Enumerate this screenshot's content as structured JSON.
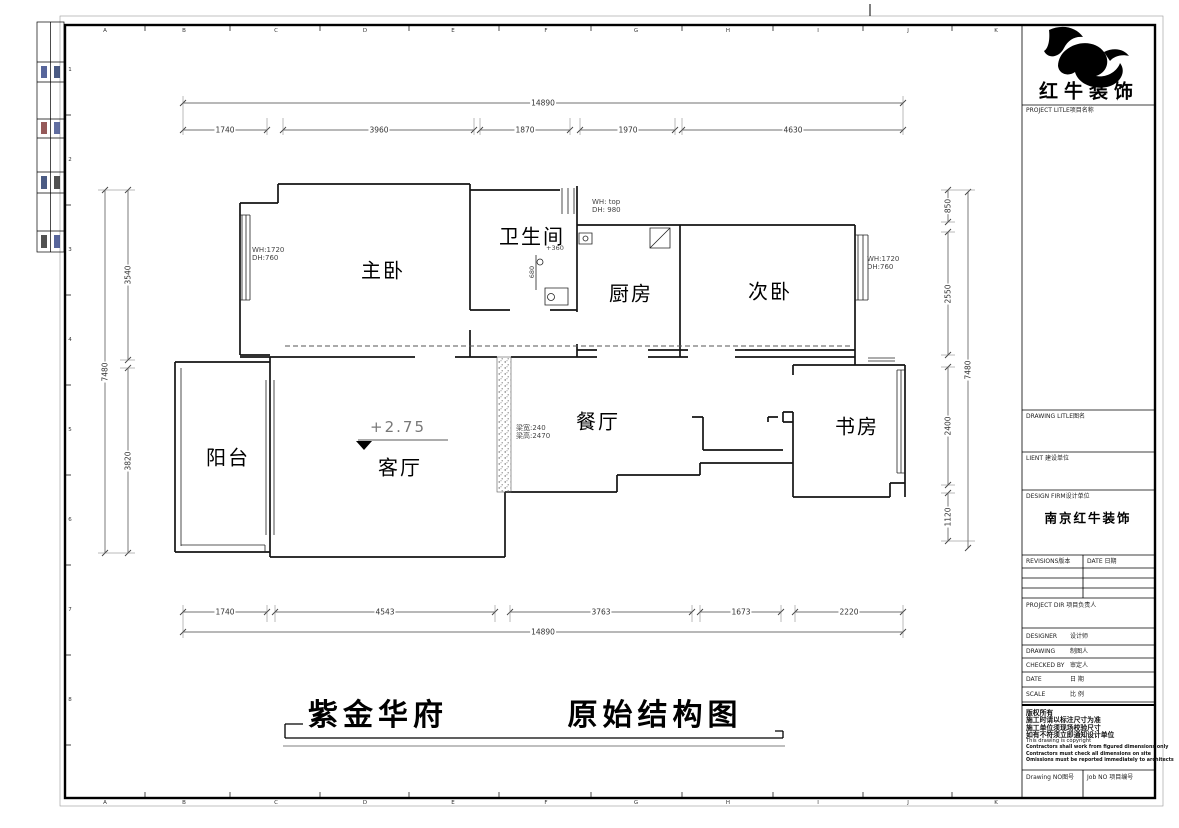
{
  "sheet": {
    "grid_letters": [
      "A",
      "B",
      "C",
      "D",
      "E",
      "F",
      "G",
      "H",
      "I",
      "J",
      "K"
    ],
    "grid_numbers": [
      "1",
      "2",
      "3",
      "4",
      "5",
      "6",
      "7",
      "8"
    ]
  },
  "footer": {
    "project_name": "紫金华府",
    "drawing_name": "原始结构图"
  },
  "title_block": {
    "brand": "红牛装饰",
    "project_title_label": "PROJECT LITLE项目名称",
    "drawing_title_label": "DRAWING LITLE图名",
    "client_label": "LIENT 建设单位",
    "design_firm_label": "DESIGN FIRM设计单位",
    "design_firm_value": "南京红牛装饰",
    "revisions_label": "REVISIONS版本",
    "revision_date_label": "DATE 日期",
    "project_dir_label": "PROJECT DIR 项目负责人",
    "designer_label": "DESIGNER",
    "designer_cn": "设计师",
    "draftsman_label": "DRAWING",
    "draftsman_cn": "制图人",
    "checked_label": "CHECKED BY",
    "checked_cn": "审定人",
    "date_label": "DATE",
    "date_cn": "日 期",
    "scale_label": "SCALE",
    "scale_cn": "比 例",
    "copyright_cn": [
      "版权所有",
      "施工时请以标注尺寸为准",
      "施工单位须现场校验尺寸",
      "如有不符须立即通知设计单位"
    ],
    "copyright_en_plain": "This drawing is copyright",
    "copyright_en_bold": [
      "Contractors shall work from figured dimensions only",
      "Contractors must check all dimensions on site",
      "Omissions must be reported immediately to architects"
    ],
    "drawing_no_label": "Drawing NO图号",
    "job_no_label": "Job NO 项目编号"
  },
  "plan": {
    "rooms": {
      "master_bedroom": "主卧",
      "bathroom": "卫生间",
      "kitchen": "厨房",
      "second_bedroom": "次卧",
      "balcony": "阳台",
      "living_room": "客厅",
      "dining_room": "餐厅",
      "study": "书房"
    },
    "level_mark": "+2.75",
    "annotations": {
      "master_window_wh": "WH:1720",
      "master_window_dh": "DH:760",
      "top_window_wh": "WH: top",
      "top_window_dh": "DH: 980",
      "second_window_wh": "WH:1720",
      "second_window_dh": "DH:760",
      "bath_level": "+360",
      "bath_dim": "680",
      "beam_width": "梁宽:240",
      "beam_height": "梁高:2470"
    },
    "dims": {
      "top_total": "14890",
      "top_segments": [
        "1740",
        "3960",
        "1870",
        "1970",
        "4630"
      ],
      "bottom_segments": [
        "1740",
        "4543",
        "3763",
        "1673",
        "2220"
      ],
      "bottom_total": "14890",
      "left_total": "7480",
      "left_segments": [
        "3540",
        "3820"
      ],
      "right_segments": [
        "850",
        "2550",
        "2400",
        "1120"
      ],
      "right_total": "7480"
    }
  }
}
